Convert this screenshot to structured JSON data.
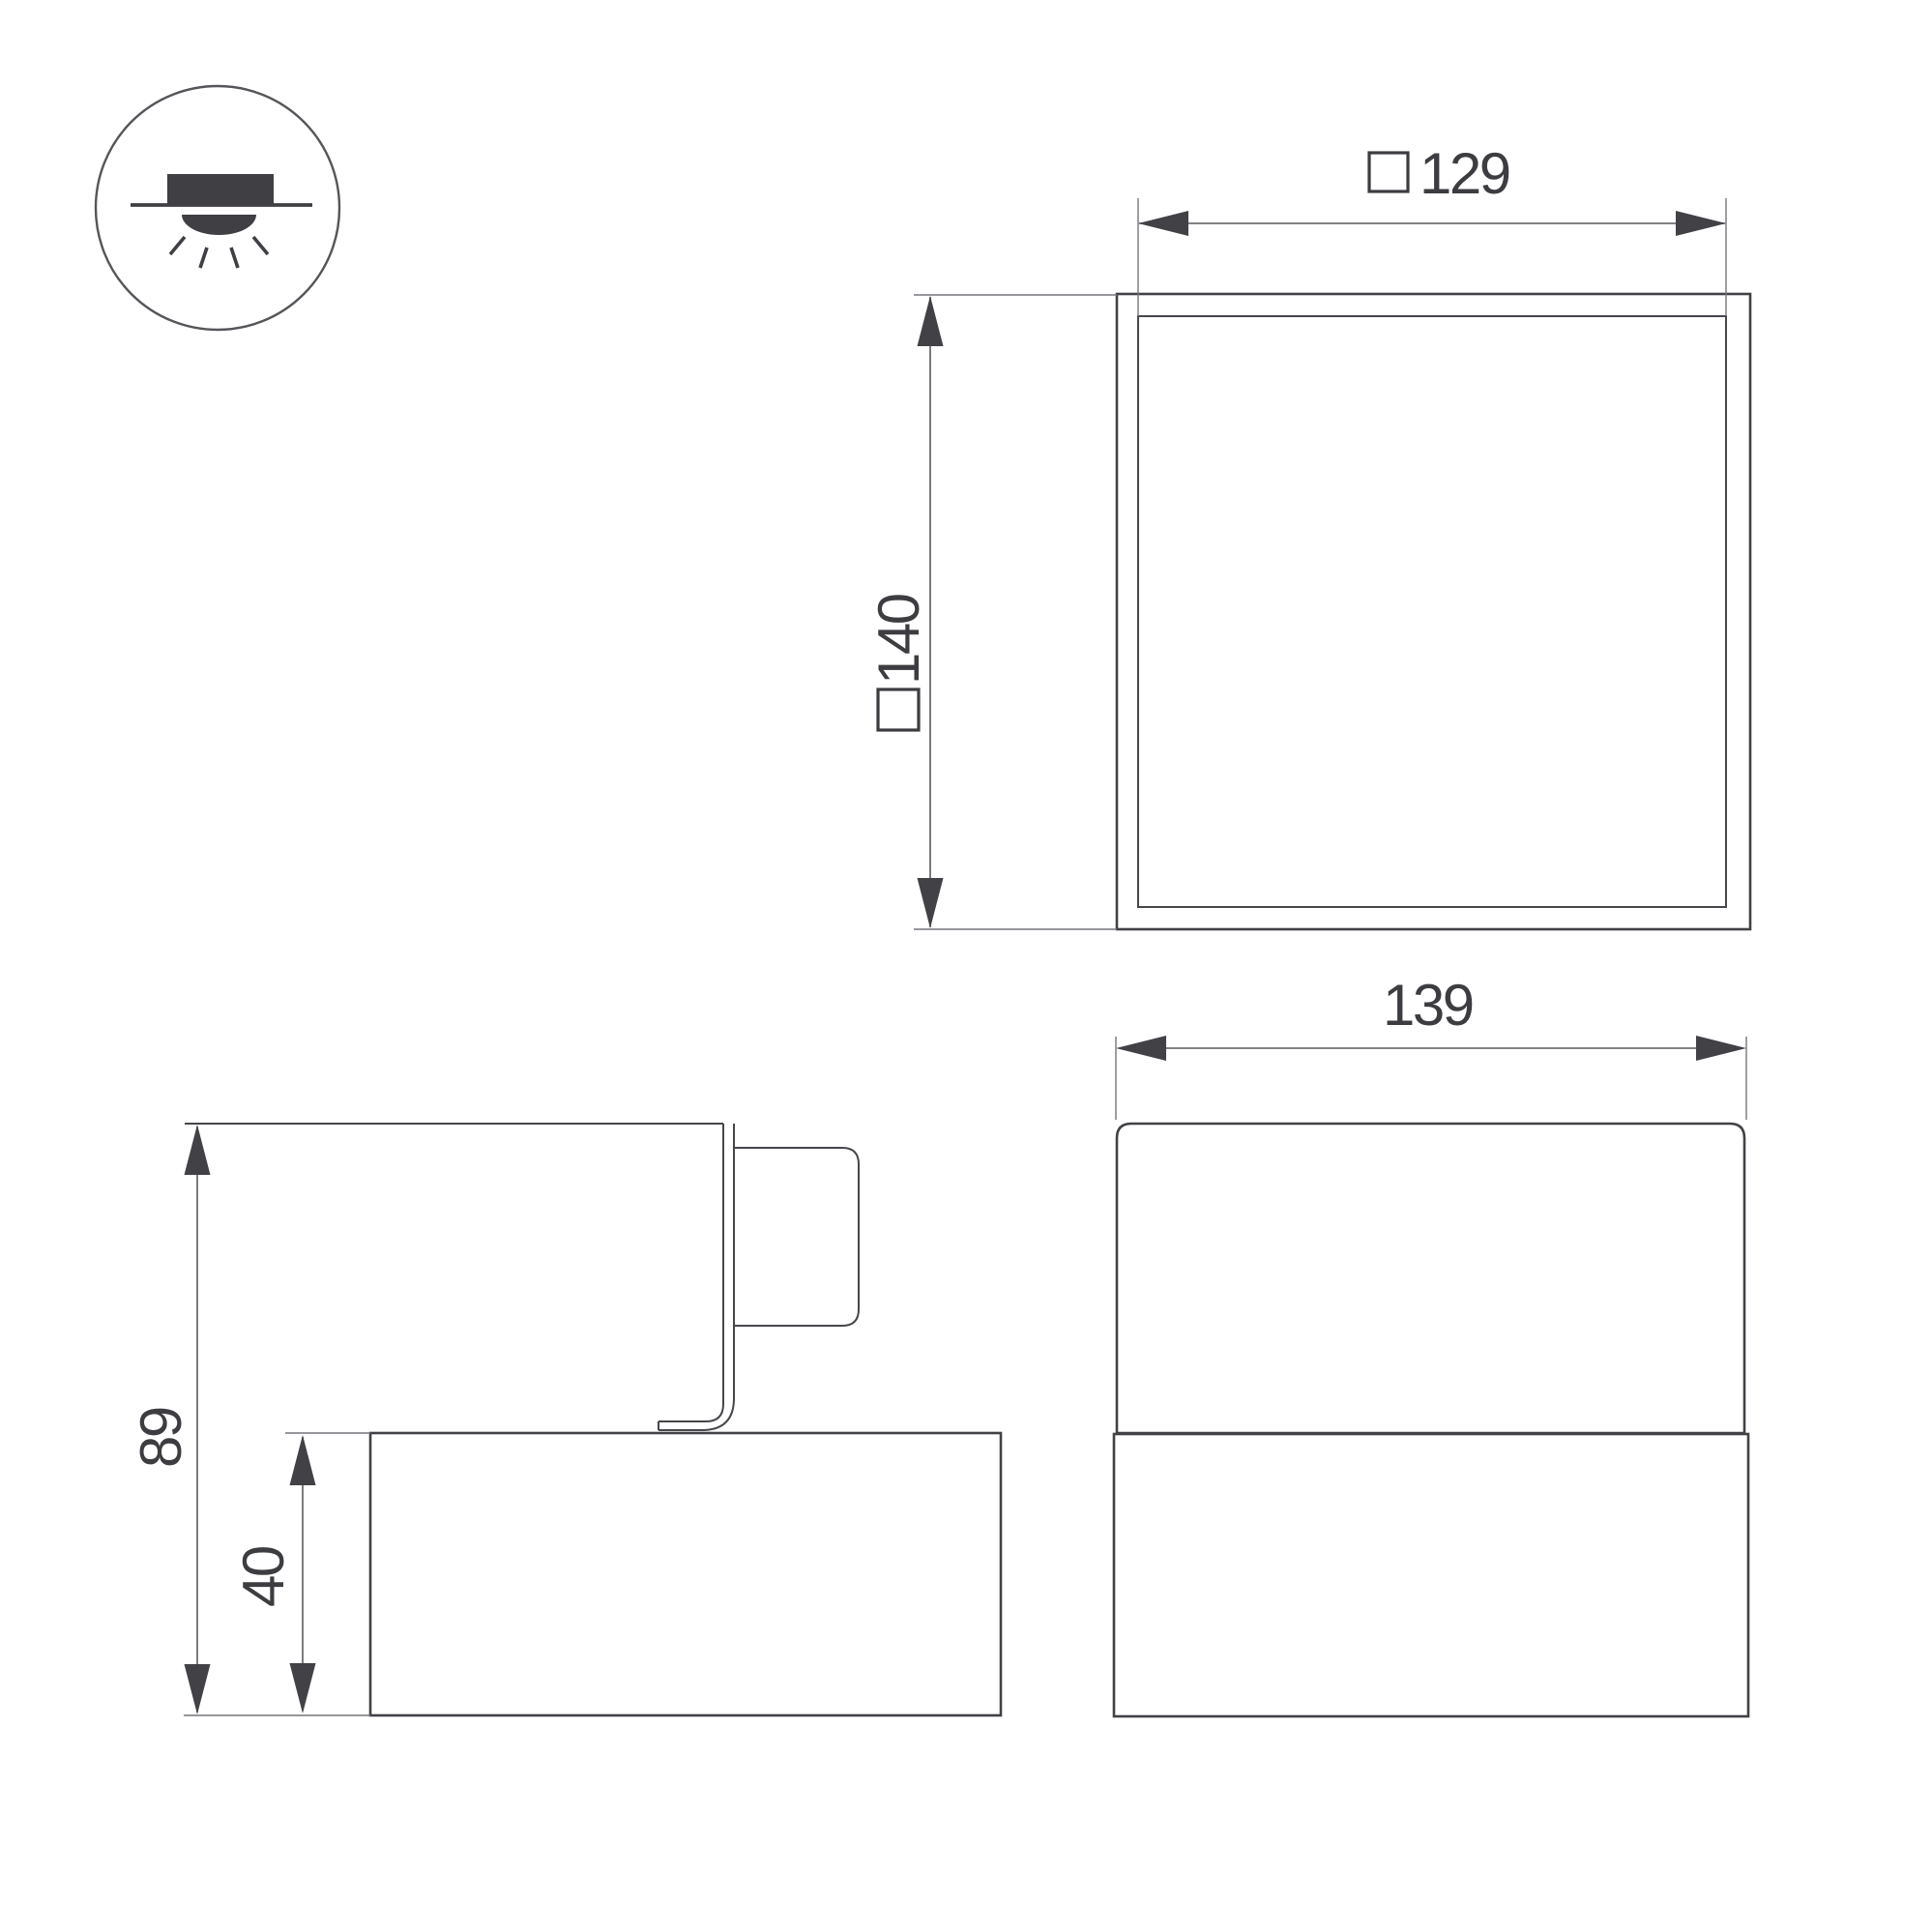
{
  "icons": {
    "mount_type": "surface-mounted-ceiling-light-icon"
  },
  "dimensions": {
    "plan_opening": {
      "square_prefix": "□",
      "value": "129"
    },
    "plan_body": {
      "square_prefix": "□",
      "value": "140"
    },
    "front_width": {
      "value": "139"
    },
    "side_total_height": {
      "value": "89"
    },
    "side_recess_depth": {
      "value": "40"
    }
  },
  "colors": {
    "ink": "#3f3f44",
    "thin_line": "#75757b",
    "background": "#ffffff"
  }
}
